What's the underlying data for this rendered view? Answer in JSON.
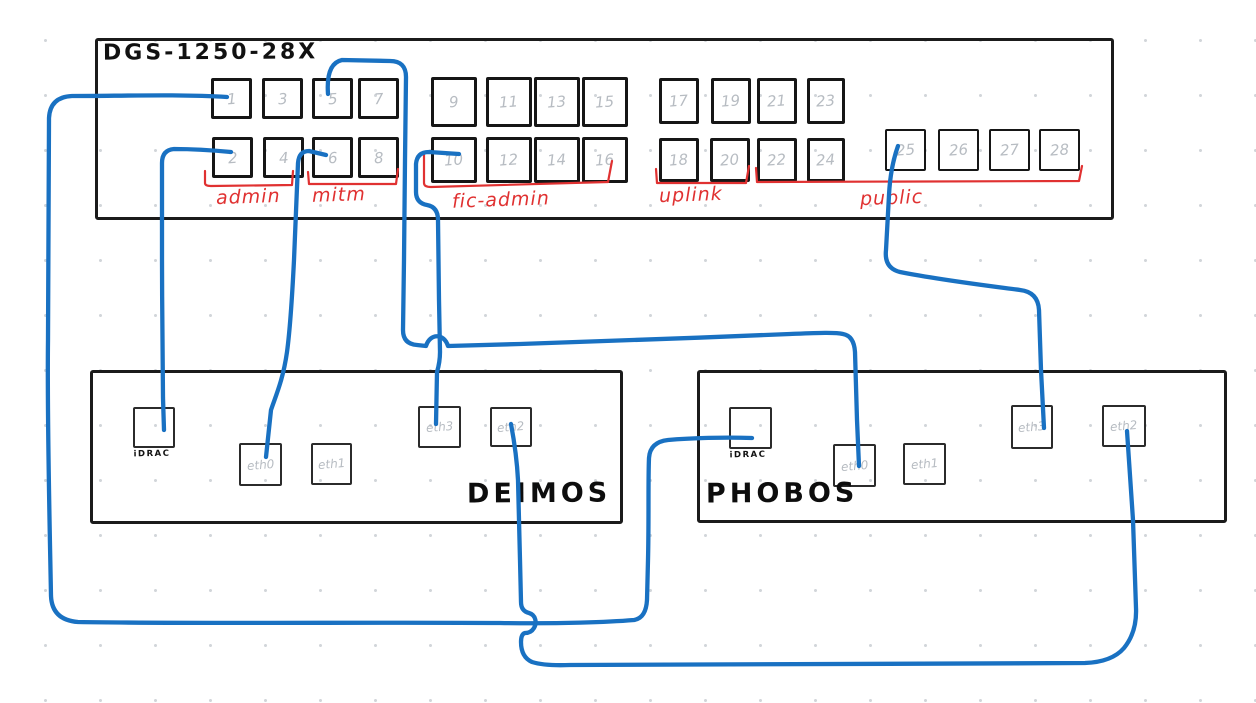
{
  "switch": {
    "title": "DGS-1250-28X",
    "ports": [
      "1",
      "2",
      "3",
      "4",
      "5",
      "6",
      "7",
      "8",
      "9",
      "10",
      "11",
      "12",
      "13",
      "14",
      "15",
      "16",
      "17",
      "18",
      "19",
      "20",
      "21",
      "22",
      "23",
      "24",
      "25",
      "26",
      "27",
      "28"
    ],
    "groups": [
      {
        "label": "admin",
        "ports": "1-4"
      },
      {
        "label": "mitm",
        "ports": "5-8"
      },
      {
        "label": "fic-admin",
        "ports": "9-16"
      },
      {
        "label": "uplink",
        "ports": "17-20"
      },
      {
        "label": "public",
        "ports": "21-28"
      }
    ]
  },
  "servers": [
    {
      "name": "DEIMOS",
      "ports": [
        "iDRAC",
        "eth0",
        "eth1",
        "eth3",
        "eth2"
      ]
    },
    {
      "name": "PHOBOS",
      "ports": [
        "iDRAC",
        "eth0",
        "eth1",
        "eth3",
        "eth2"
      ]
    }
  ],
  "connections": [
    {
      "from": "switch port 1",
      "to": "PHOBOS iDRAC",
      "group": "admin"
    },
    {
      "from": "switch port 2",
      "to": "DEIMOS iDRAC",
      "group": "admin"
    },
    {
      "from": "switch port 5",
      "to": "PHOBOS eth0",
      "group": "mitm"
    },
    {
      "from": "switch port 6",
      "to": "DEIMOS eth0",
      "group": "mitm"
    },
    {
      "from": "switch port 10",
      "to": "DEIMOS eth3",
      "group": "fic-admin"
    },
    {
      "from": "switch port 25",
      "to": "PHOBOS eth3",
      "group": "public"
    },
    {
      "from": "DEIMOS eth2",
      "to": "PHOBOS eth2",
      "group": "direct"
    }
  ],
  "colors": {
    "cable": "#1971c2",
    "annotation": "#e03131",
    "ink": "#1b1b1b",
    "port_number": "#b7bcc2"
  }
}
